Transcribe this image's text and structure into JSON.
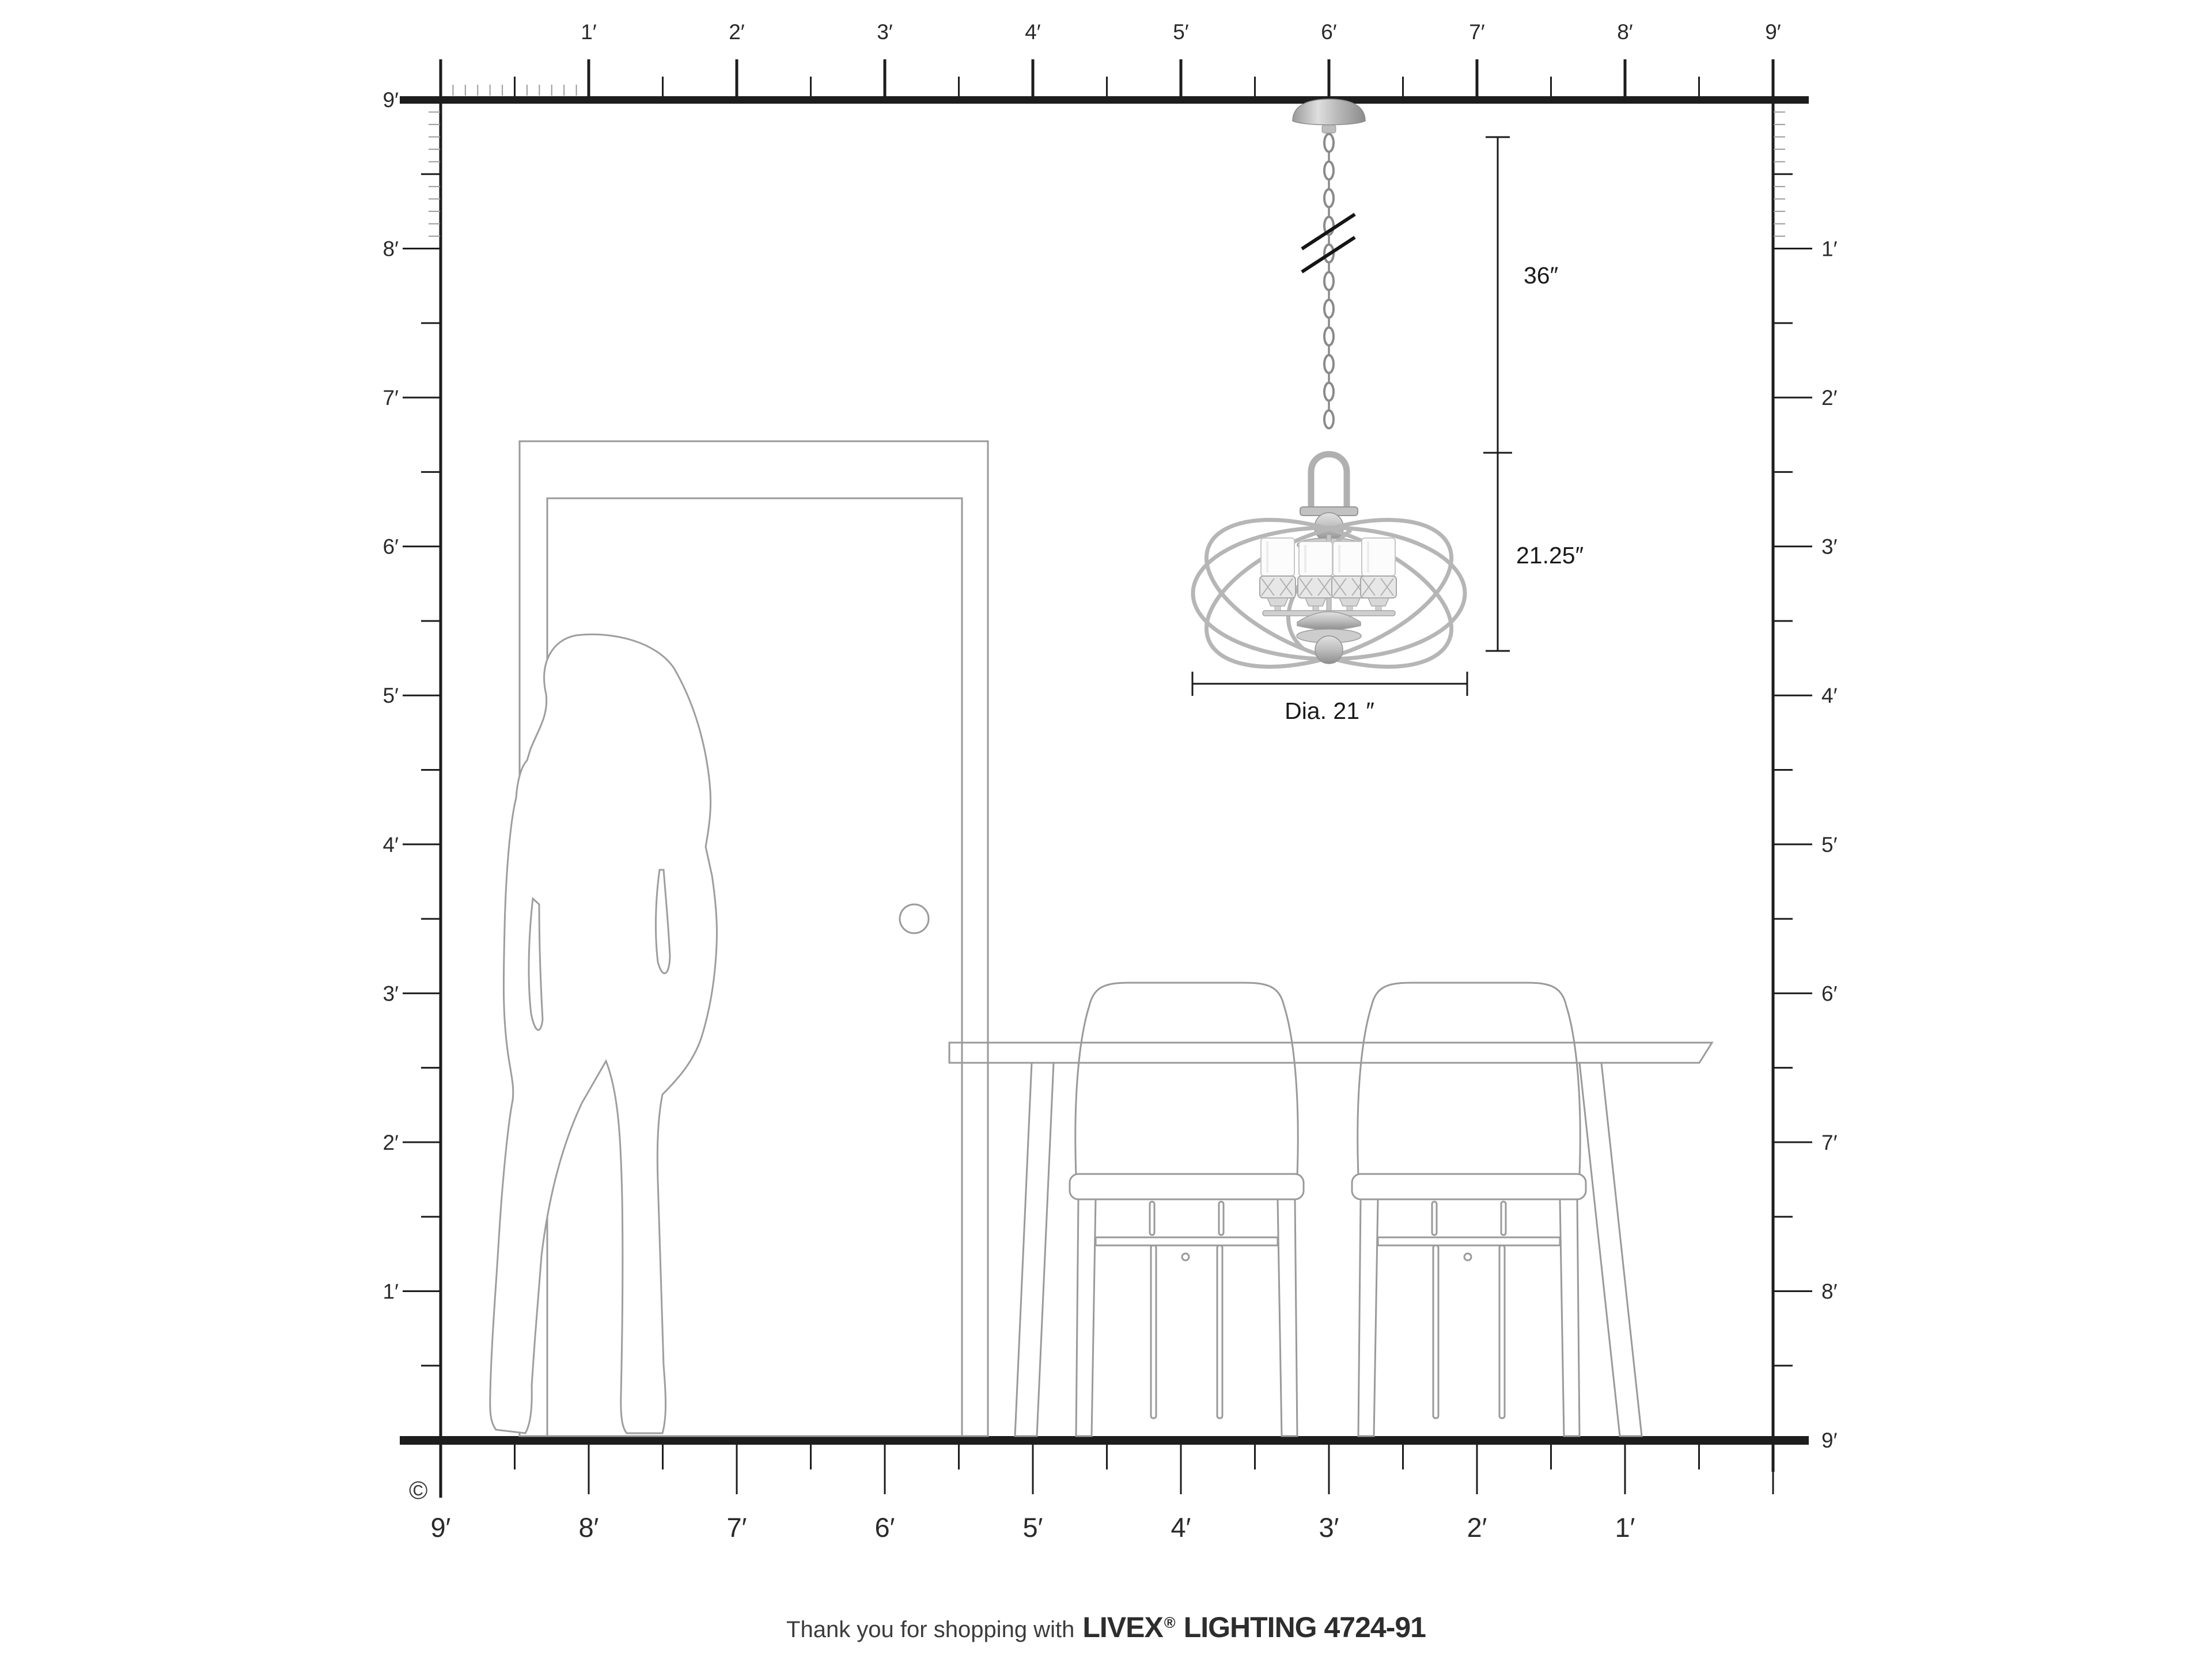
{
  "title": "Livex Lighting pendant size diagram",
  "rulers": {
    "top": {
      "labels": [
        "1′",
        "2′",
        "3′",
        "4′",
        "5′",
        "6′",
        "7′",
        "8′",
        "9′"
      ]
    },
    "left": {
      "labels": [
        "9′",
        "8′",
        "7′",
        "6′",
        "5′",
        "4′",
        "3′",
        "2′",
        "1′"
      ]
    },
    "right": {
      "labels": [
        "1′",
        "2′",
        "3′",
        "4′",
        "5′",
        "6′",
        "7′",
        "8′",
        "9′"
      ]
    },
    "bottom": {
      "labels": [
        "9′",
        "8′",
        "7′",
        "6′",
        "5′",
        "4′",
        "3′",
        "2′",
        "1′"
      ]
    }
  },
  "dimensions": {
    "chain_length": "36″",
    "fixture_height": "21.25″",
    "diameter": "Dia. 21 ″"
  },
  "footer": {
    "prefix": "Thank you for shopping with",
    "brand": "LIVEX",
    "registered": "®",
    "suffix": "LIGHTING 4724-91"
  },
  "copyright_symbol": "©",
  "colors": {
    "ruler_ink": "#1d1d1d",
    "inch_tick": "#9b9b9b",
    "drawing_line": "#9a9a9a",
    "metal_light": "#d9d9d9",
    "metal_dark": "#8e8e8e",
    "dimension_ink": "#1a1a1a"
  }
}
